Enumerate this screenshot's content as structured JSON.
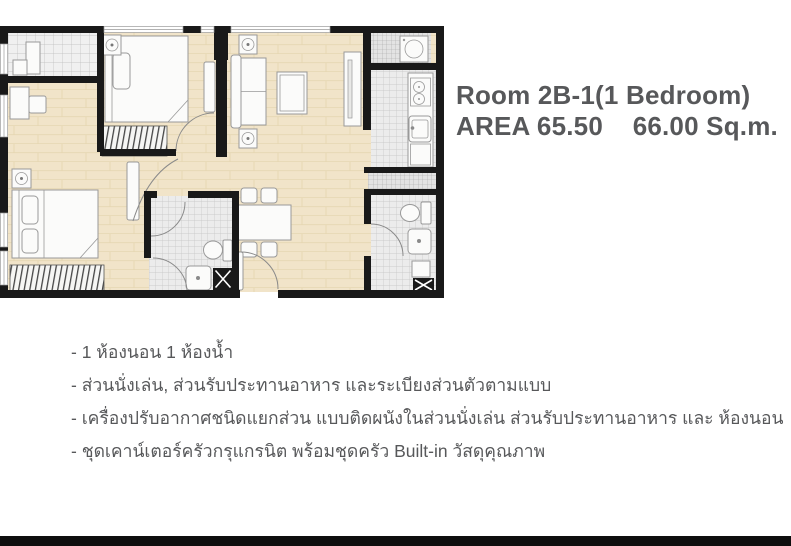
{
  "header": {
    "title": "Room 2B-1(1 Bedroom)",
    "area_line": "AREA 65.50    66.00 Sq.m.",
    "text_color": "#57585a"
  },
  "features": {
    "bullets": [
      "- 1 ห้องนอน 1 ห้องน้ำ",
      "- ส่วนนั่งเล่น, ส่วนรับประทานอาหาร และระเบียงส่วนตัวตามแบบ",
      "- เครื่องปรับอากาศชนิดแยกส่วน แบบติดผนังในส่วนนั่งเล่น ส่วนรับประทานอาหาร และ ห้องนอน",
      "- ชุดเคาน์เตอร์ครัวกรุแกรนิต พร้อมชุดครัว Built-in วัสดุคุณภาพ"
    ]
  },
  "floor_plan": {
    "colors": {
      "wall": "#191919",
      "wood_floor": "#f1e4c9",
      "tile_floor": "#ececec",
      "tile_line": "#c3c3c3",
      "furniture_fill": "#fbfbfa",
      "furniture_stroke": "#999999",
      "door_arc": "#8a8a8a"
    }
  },
  "footer": {
    "bar_color": "#0e0e0e"
  }
}
